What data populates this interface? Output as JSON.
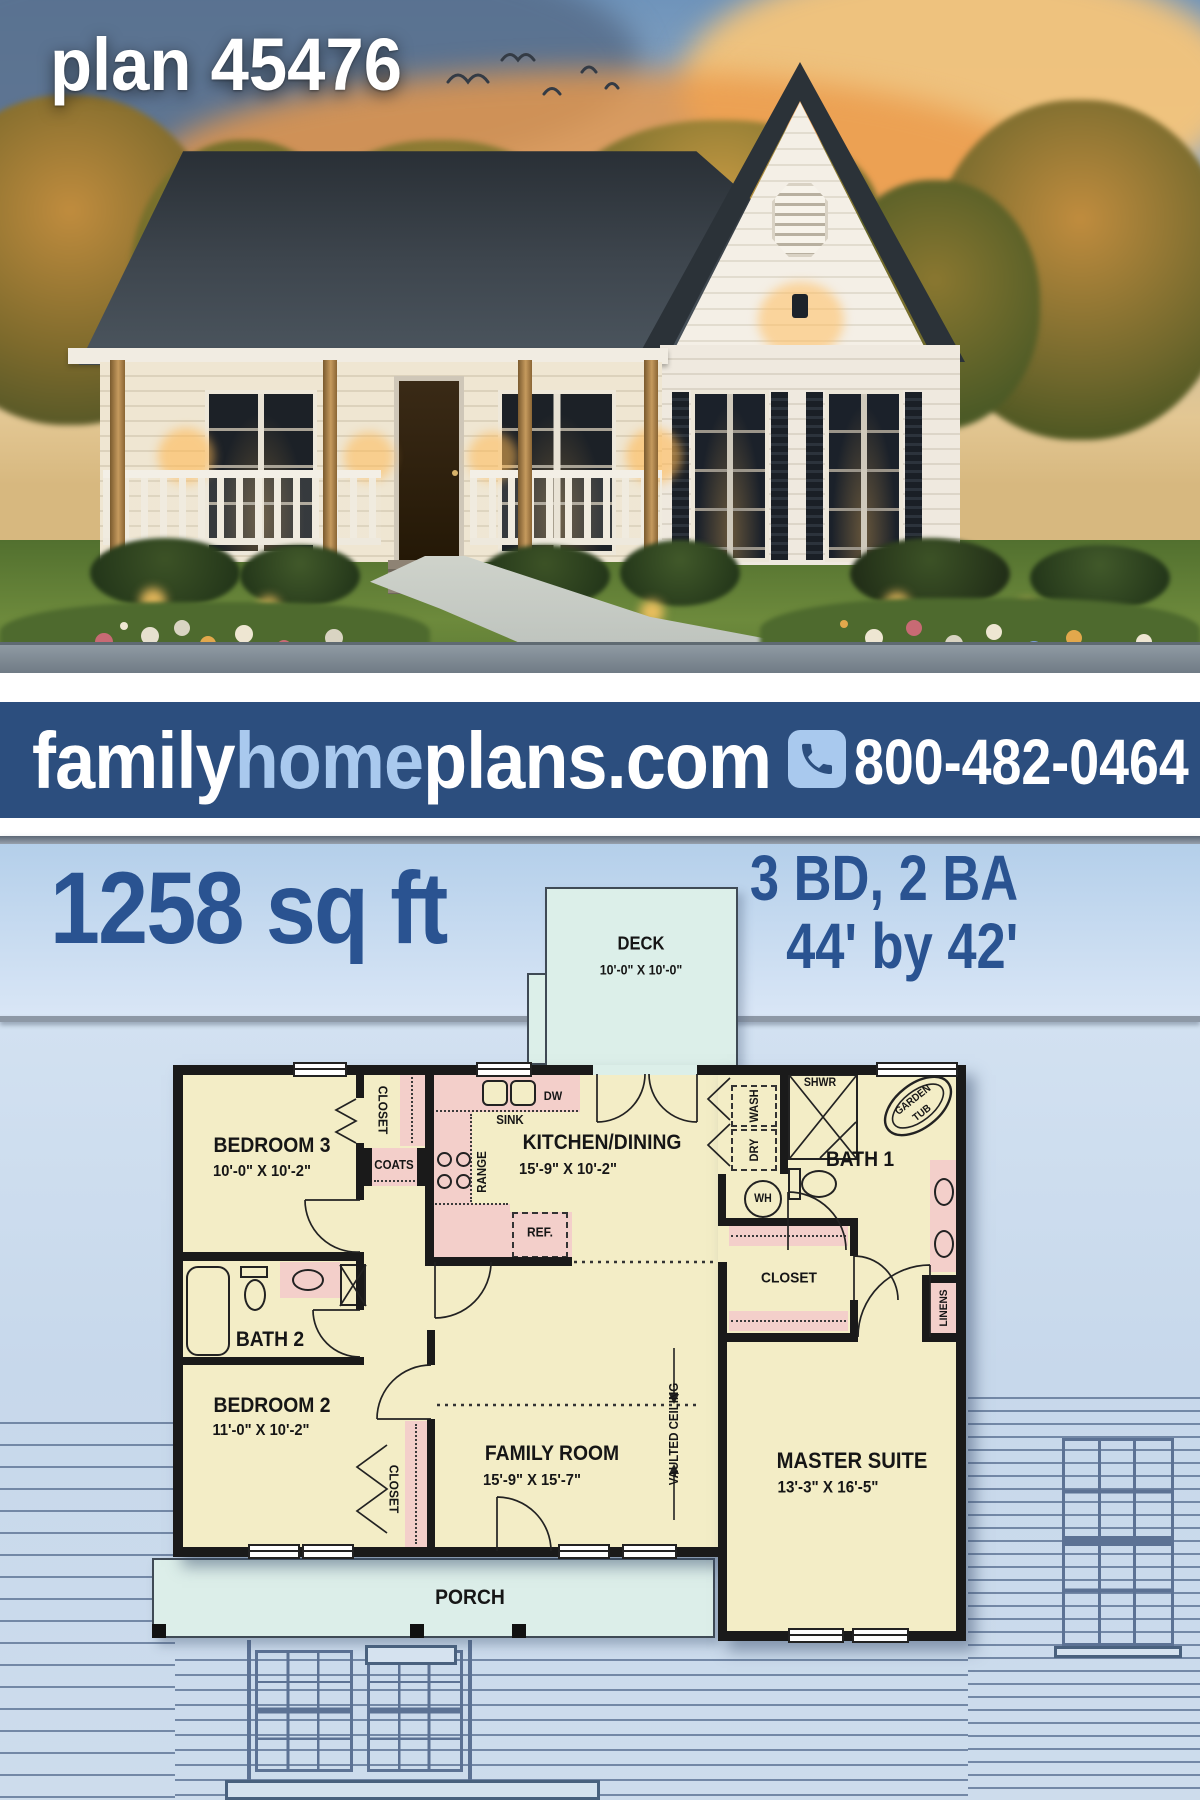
{
  "hero": {
    "plan_label": "plan 45476"
  },
  "banner": {
    "brand_family": "family",
    "brand_home": "home",
    "brand_rest": "plans.com",
    "phone": "800-482-0464"
  },
  "stats": {
    "sqft": "1258 sq ft",
    "bd_ba": "3 BD, 2 BA",
    "size": "44' by 42'"
  },
  "floorplan": {
    "deck": {
      "name": "DECK",
      "dims": "10'-0\" X 10'-0\""
    },
    "bedroom3": {
      "name": "BEDROOM 3",
      "dims": "10'-0\" X 10'-2\""
    },
    "kitchen": {
      "name": "KITCHEN/DINING",
      "dims": "15'-9\" X 10'-2\""
    },
    "bath1": {
      "name": "BATH 1"
    },
    "bath2": {
      "name": "BATH 2"
    },
    "bedroom2": {
      "name": "BEDROOM 2",
      "dims": "11'-0\" X 10'-2\""
    },
    "family": {
      "name": "FAMILY ROOM",
      "dims": "15'-9\" X 15'-7\""
    },
    "master": {
      "name": "MASTER SUITE",
      "dims": "13'-3\" X 16'-5\""
    },
    "porch": {
      "name": "PORCH"
    },
    "closet_bedroom3": "CLOSET",
    "closet_master": "CLOSET",
    "closet_bedroom2": "CLOSET",
    "coats": "COATS",
    "linens": "LINENS",
    "sink": "SINK",
    "dw": "DW",
    "range": "RANGE",
    "ref": "REF.",
    "wash": "WASH",
    "dry": "DRY",
    "wh": "WH",
    "shwr": "SHWR",
    "garden_tub_line1": "GARDEN",
    "garden_tub_line2": "TUB",
    "vaulted": "VAULTED CEILING"
  },
  "colors": {
    "banner_bg": "#2c4e7e",
    "banner_accent": "#a9c9ee",
    "headline_blue": "#2a5391",
    "room_fill": "#f3edc6",
    "wet_fill": "#f3cfca",
    "wall": "#1a1a1a",
    "porch_fill": "#dceee9",
    "background_blue": "#cddcec"
  }
}
